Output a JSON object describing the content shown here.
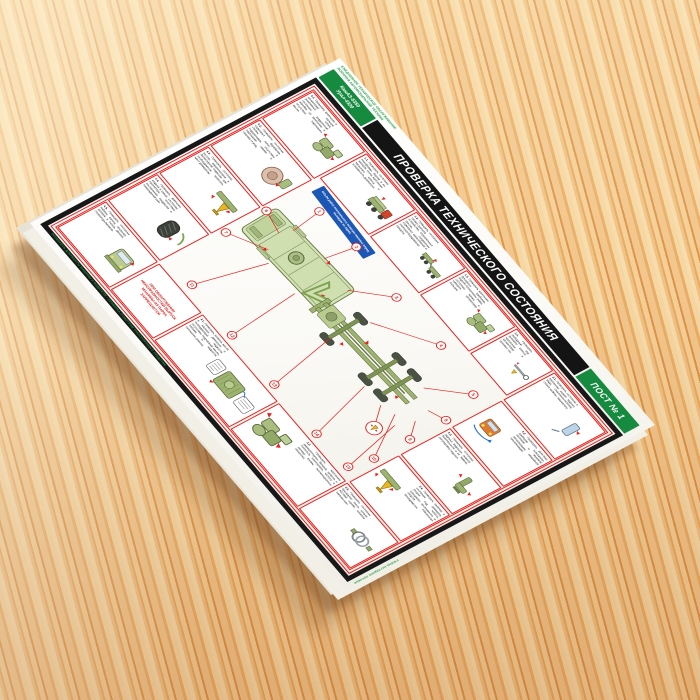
{
  "poster": {
    "note_line1": "ЕЖЕДНЕВНОЕ ТЕХНИЧЕСКОЕ ОБСЛУЖИВАНИЕ",
    "note_line2": "ВОЕННОЙ АВТОМОБИЛЬНОЙ ТЕХНИКИ",
    "models_line1": "КамАЗ-5350",
    "models_line2": "Урал-4320",
    "title": "ПРОВЕРКА ТЕХНИЧЕСКОГО СОСТОЯНИЯ",
    "post_label": "ПОСТ № 1",
    "ribbon_text": "Объём работ контрольного осмотра машины перед выходом из парка",
    "bottom_note": "ПРОВЕРИТЬ ДОКУМЕНТЫ МАШИНЫ И ВОДИТЕЛЯ • ПРОВЕРКА ОСМОТРОМ ТРАНСПОРТНОГО СРЕДСТВА",
    "side_note": "УЧЕБНО-НАГЛЯДНОЕ ПОСОБИЕ",
    "colors": {
      "accent_red": "#e8211d",
      "banner_black": "#141414",
      "green": "#168a3f",
      "ribbon_blue": "#1c57b5",
      "board_white": "#ffffff"
    },
    "boxes": [
      {
        "id": "T1",
        "step": "1.1.",
        "illu": "truck",
        "text": "Проверить состояние платформы, бортов и их запоров, тента, крепление запасного колеса и исправность держателя."
      },
      {
        "id": "T2",
        "step": "1.2.",
        "illu": "trailer",
        "text": "Проверить состояние тягово-сцепного устройства, страховочных тросов, соединение тормозных магистралей и электрооборудования прицепа."
      },
      {
        "id": "T3",
        "step": "1.3.",
        "illu": "machinery",
        "text": "Проверить крепление буксирных приборов, задней поперечины рамы, состояние крюка и шкворня, шплинтовку пальцев."
      },
      {
        "id": "T4",
        "step": "1.4.",
        "illu": "towbar",
        "text": "Проверить свободный ход рулевого колеса, крепление и шплинтовку рулевых тяг."
      },
      {
        "id": "R1",
        "step": "2.1.",
        "illu": "mirror",
        "text": "Проверить состояние и крепление зеркал заднего вида, стеклоочистителей, стёкол кабины, омывателя."
      },
      {
        "id": "R2",
        "step": "2.2.",
        "illu": "lampcheck",
        "text": "Проверить действие приборов освещения, световой и звуковой сигнализации, аварийной сигнализации."
      },
      {
        "id": "R3",
        "step": "2.3.",
        "illu": "seat",
        "text": "Проверить состояние сиденья водителя, ремней безопасности и их замков, регулировку сиденья."
      },
      {
        "id": "R4",
        "step": "2.4.",
        "illu": "jack",
        "text": "Проверить наличие и состояние домкрата, упоров под колёса, шанцевого инструмента и средств повышения проходимости."
      },
      {
        "id": "R5",
        "step": "2.5.",
        "illu": "hose",
        "text": "Проверить состояние буксирного троса, штанги жёсткой сцепки, шлангов накачки шин."
      },
      {
        "id": "B1",
        "step": "",
        "illu": "none",
        "warn": true,
        "text": "ПРИ ОБНАРУЖЕНИИ НЕИСПРАВНОСТЕЙ ВЫПУСК МАШИНЫ ИЗ ПАРКА ЗАПРЕЩАЕТСЯ"
      },
      {
        "id": "B2",
        "step": "3.1.",
        "illu": "engine",
        "text": "Проверить уровень масла в картере двигателя и охлаждающей жидкости, отсутствие подтеканий масла, топлива и жидкости, натяжение ремней."
      },
      {
        "id": "B3",
        "step": "3.2.",
        "illu": "machinery",
        "text": "Проверить крепление аккумуляторных батарей, уровень и плотность электролита, чистоту и затяжку клемм, вентиляционные отверстия."
      },
      {
        "id": "L1",
        "step": "4.1.",
        "illu": "machinery",
        "text": "Проверить крепление и шплинтовку пальцев реактивных штанг, состояние раздаточной коробки, её крепление и отсутствие подтекания масла."
      },
      {
        "id": "L2",
        "step": "4.2.",
        "illu": "wheelhub",
        "text": "Проверить состояние тормозных барабанов, ступиц колёс и подшипников, отсутствие подтекания смазки и нагрева ступиц."
      },
      {
        "id": "L3",
        "step": "4.3.",
        "illu": "jack",
        "text": "Проверить состояние рессор, амортизаторов и балансирной подвески; при необходимости вывесить мост домкратом."
      },
      {
        "id": "L4",
        "step": "4.4.",
        "illu": "tire",
        "text": "Проверить давление воздуха в шинах, состояние протектора, отсутствие посторонних предметов и повреждений шин."
      },
      {
        "id": "L5",
        "step": "4.5.",
        "illu": "cab",
        "text": "Проверить состояние кабины, капота, оперения, запоров и петель дверей, стеклоподъёмников."
      }
    ],
    "callouts": [
      {
        "n": 1,
        "x": 60,
        "y": 40
      },
      {
        "n": 2,
        "x": 160,
        "y": 30
      },
      {
        "n": 3,
        "x": 290,
        "y": 35
      },
      {
        "n": 4,
        "x": 420,
        "y": 30
      },
      {
        "n": 5,
        "x": 540,
        "y": 45
      },
      {
        "n": 6,
        "x": 8,
        "y": 120
      },
      {
        "n": 7,
        "x": 8,
        "y": 210
      },
      {
        "n": 8,
        "x": 560,
        "y": 120
      },
      {
        "n": 9,
        "x": 560,
        "y": 200
      },
      {
        "n": 10,
        "x": 560,
        "y": 280
      },
      {
        "n": 11,
        "x": 70,
        "y": 330
      },
      {
        "n": 12,
        "x": 200,
        "y": 335
      },
      {
        "n": 13,
        "x": 330,
        "y": 335
      },
      {
        "n": 14,
        "x": 460,
        "y": 335
      },
      {
        "n": 15,
        "x": 550,
        "y": 330
      }
    ],
    "lines": [
      [
        60,
        40,
        70,
        105
      ],
      [
        160,
        30,
        150,
        95
      ],
      [
        290,
        35,
        230,
        100
      ],
      [
        420,
        30,
        310,
        108
      ],
      [
        540,
        45,
        480,
        112
      ],
      [
        8,
        120,
        60,
        130
      ],
      [
        8,
        210,
        80,
        168
      ],
      [
        560,
        120,
        525,
        135
      ],
      [
        560,
        200,
        532,
        168
      ],
      [
        560,
        280,
        500,
        190
      ],
      [
        70,
        330,
        105,
        185
      ],
      [
        200,
        335,
        185,
        185
      ],
      [
        330,
        335,
        300,
        190
      ],
      [
        460,
        335,
        420,
        200
      ],
      [
        550,
        330,
        520,
        205
      ],
      [
        505,
        240,
        470,
        200
      ]
    ],
    "magnifier": {
      "x": 505,
      "y": 240,
      "r": 15
    }
  }
}
